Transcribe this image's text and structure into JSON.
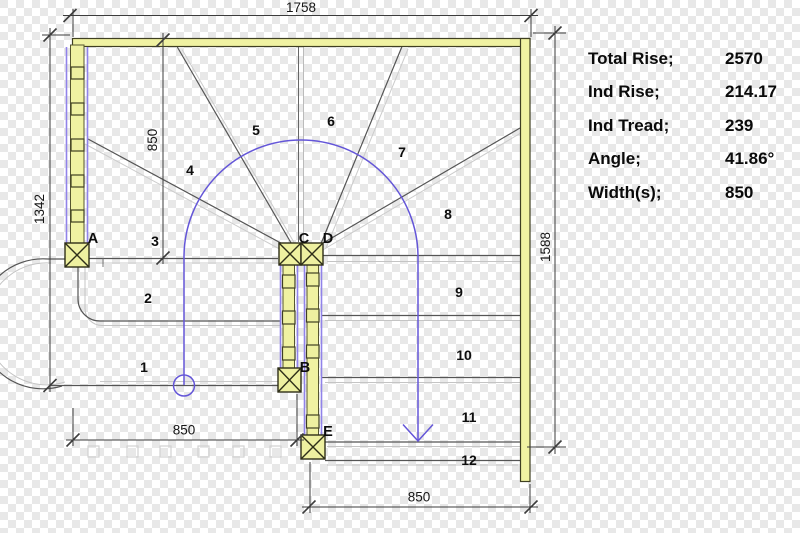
{
  "panel": {
    "rows": [
      {
        "label": "Total Rise;",
        "value": "2570"
      },
      {
        "label": "Ind Rise;",
        "value": "214.17"
      },
      {
        "label": "Ind Tread;",
        "value": "239"
      },
      {
        "label": "Angle;",
        "value": "41.86°"
      },
      {
        "label": "Width(s);",
        "value": "850"
      }
    ]
  },
  "dimensions": {
    "top_width": "1758",
    "left_height": "1342",
    "flight_width": "850",
    "right_height": "1588",
    "bottom_left_width": "850",
    "bottom_right_width": "850"
  },
  "treads": [
    "1",
    "2",
    "3",
    "4",
    "5",
    "6",
    "7",
    "8",
    "9",
    "10",
    "11",
    "12"
  ],
  "posts": [
    "A",
    "B",
    "C",
    "D",
    "E"
  ],
  "colors": {
    "wall_fill": "#f0f2a2",
    "wall_outline": "#3f3f22",
    "railing_purple": "#9183ea",
    "walk_line_blue": "#6456d8",
    "tread_line": "#555555",
    "tread_line_light": "#c4c4c4",
    "dimension_line": "#3c3c3c",
    "checker_gray": "#e8e8e8"
  }
}
